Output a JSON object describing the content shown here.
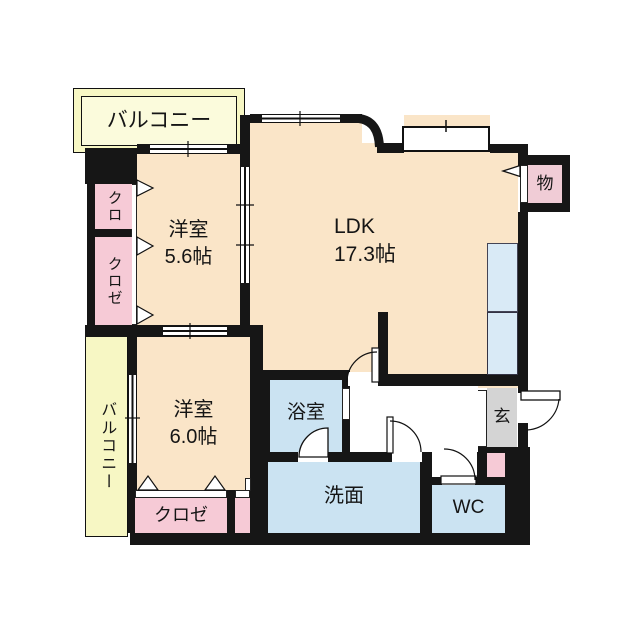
{
  "rooms": {
    "balcony_top": {
      "label": "バルコニー"
    },
    "balcony_left": {
      "label": "バルコニー"
    },
    "closet_kuro": {
      "label": "クロ"
    },
    "closet_kuroze_left": {
      "label": "クロゼ"
    },
    "bedroom1": {
      "name": "洋室",
      "size": "5.6帖"
    },
    "ldk": {
      "name": "LDK",
      "size": "17.3帖"
    },
    "storage": {
      "label": "物"
    },
    "bedroom2": {
      "name": "洋室",
      "size": "6.0帖"
    },
    "bathroom": {
      "label": "浴室"
    },
    "washroom": {
      "label": "洗面"
    },
    "toilet": {
      "label": "WC"
    },
    "entrance": {
      "label": "玄"
    },
    "closet_bottom": {
      "label": "クロゼ"
    }
  },
  "colors": {
    "wall": "#161616",
    "room_peach": "#fae5c8",
    "closet_pink": "#f6cad6",
    "storage_pink": "#f0ccd6",
    "water_blue": "#cbe3f2",
    "counter_blue": "#d9eaf6",
    "balcony_yellow": "#f7f7c4",
    "balcony_inner": "#fbfbdc",
    "entrance_gray": "#d4d4d4"
  }
}
